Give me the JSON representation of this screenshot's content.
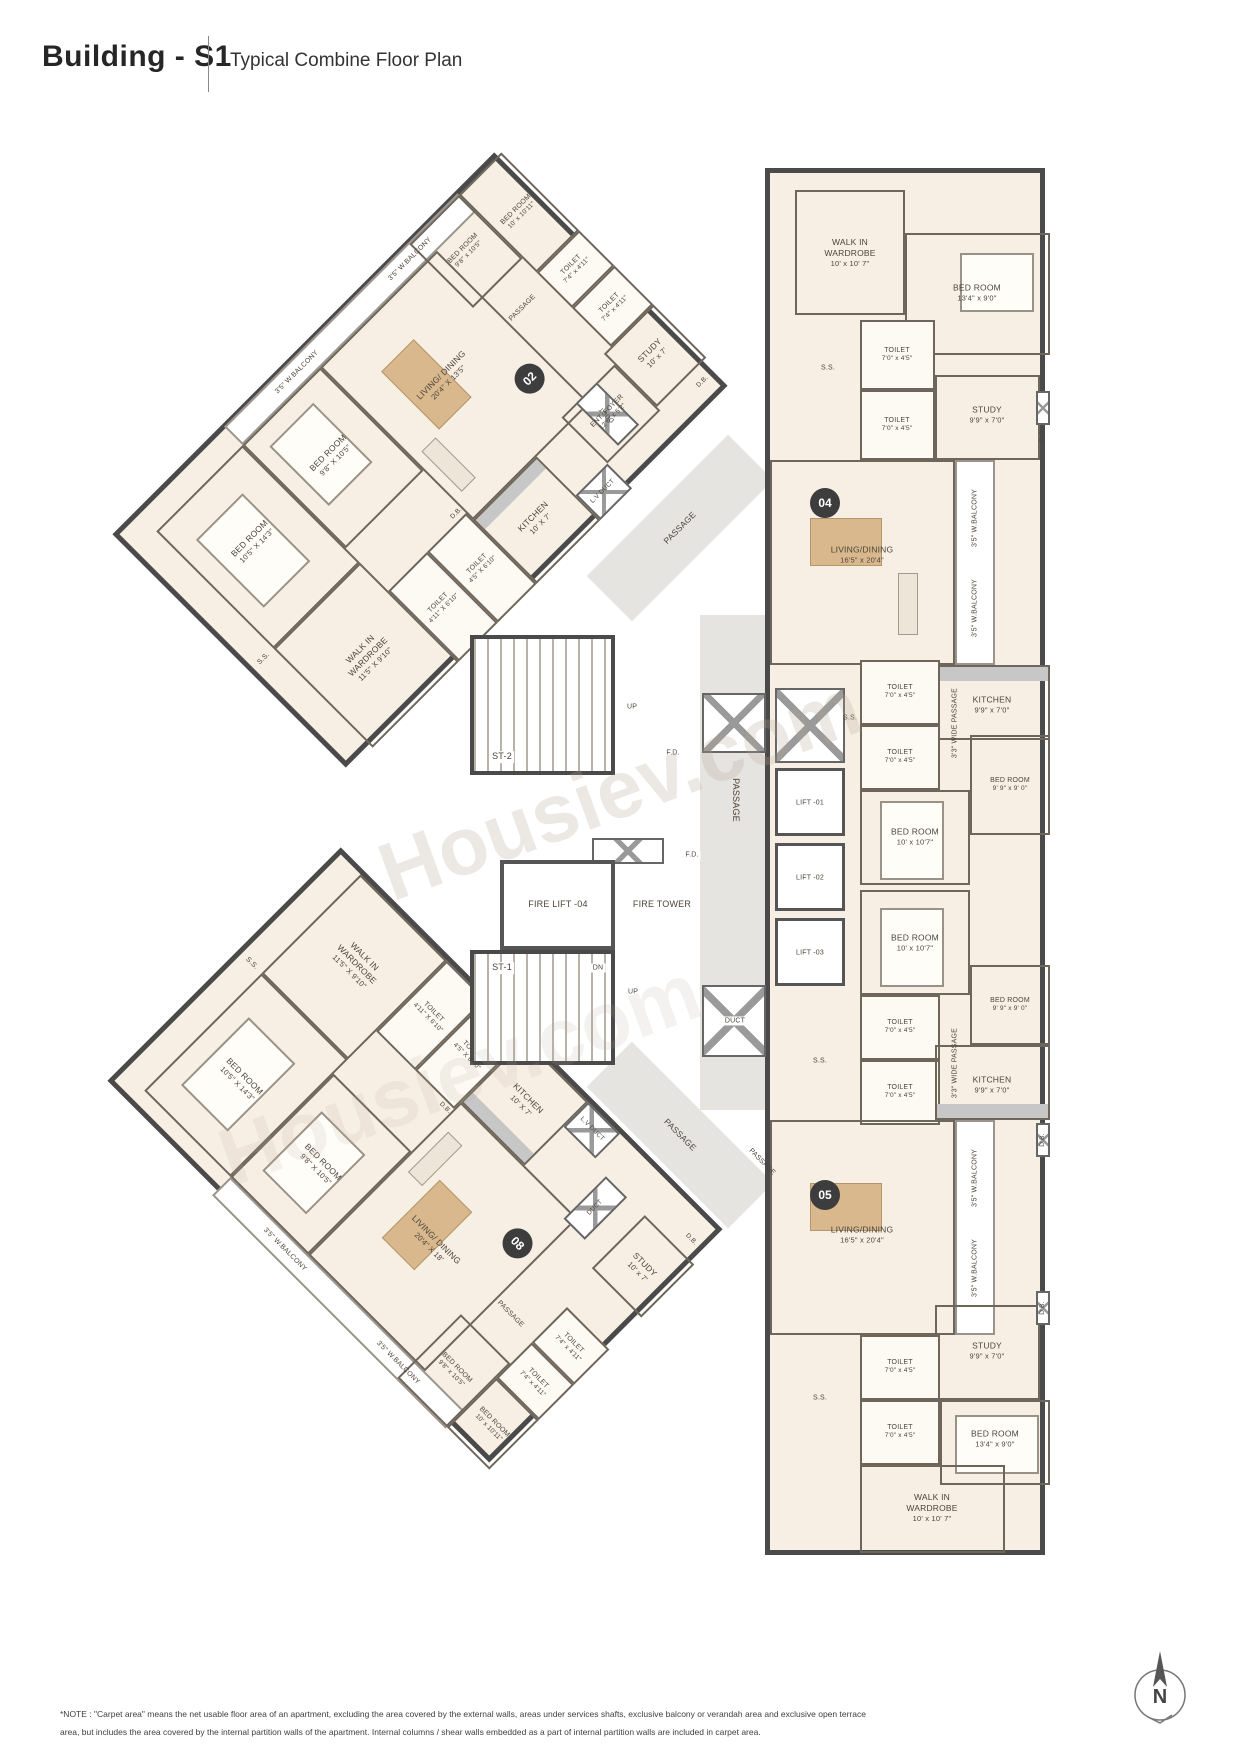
{
  "header": {
    "building": "Building - S1",
    "subtitle": "Typical Combine Floor Plan"
  },
  "watermark": "Housiev.com",
  "compass": {
    "label": "N"
  },
  "colors": {
    "wall": "#4a4a4a",
    "room_fill": "#f8efe4",
    "furniture_tan": "#d8b88c",
    "passage_gray": "#e6e4e1",
    "badge_bg": "#3d3d3d"
  },
  "core": {
    "st1": "ST-1",
    "st2": "ST-2",
    "up": "UP",
    "dn": "DN",
    "fd": "F.D.",
    "duct": "DUCT",
    "passage": "PASSAGE",
    "lift1": "LIFT -01",
    "lift2": "LIFT -02",
    "lift3": "LIFT -03",
    "fire_lift": "FIRE LIFT -04",
    "fire_tower": "FIRE TOWER"
  },
  "units": {
    "u02": {
      "badge": "02",
      "rooms": {
        "living": {
          "n": "LIVING/ DINING",
          "s": "20'4\" X 13'5\""
        },
        "ent_foyer": {
          "n": "ENT. FOYER",
          "s": "12'6\" x 5'2\""
        },
        "study": {
          "n": "STUDY",
          "s": "10' x 7'"
        },
        "kitchen": {
          "n": "KITCHEN",
          "s": "10' X 7'"
        },
        "bed_a": {
          "n": "BED ROOM",
          "s": "9'8\" x 10'5\""
        },
        "bed_b": {
          "n": "BED ROOM",
          "s": "10' x 10'11\""
        },
        "bed_c": {
          "n": "BED ROOM",
          "s": "9'8\" X 10'5\""
        },
        "bed_d": {
          "n": "BED ROOM",
          "s": "10'5\" X 14'3\""
        },
        "toilet_a": {
          "n": "TOILET",
          "s": "7'4\" x 4'11\""
        },
        "toilet_b": {
          "n": "TOILET",
          "s": "7'4\" x 4'11\""
        },
        "toilet_c": {
          "n": "TOILET",
          "s": "4'11\" X 6'10\""
        },
        "toilet_d": {
          "n": "TOILET",
          "s": "4'5\" X 6'10\""
        },
        "wiw": {
          "n": "WALK IN WARDROBE",
          "s": "11'5\" X 9'10\""
        },
        "passage": "PASSAGE",
        "balcony": "3'5\" W.BALCONY",
        "ss": "S.S.",
        "db": "D.B.",
        "duct": "DUCT",
        "lv_duct": "L.V DUCT"
      }
    },
    "u08": {
      "badge": "08",
      "rooms": {
        "living": {
          "n": "LIVING/ DINING",
          "s": "20'4\" X 18'"
        },
        "study": {
          "n": "STUDY",
          "s": "10' x 7'"
        },
        "kitchen": {
          "n": "KITCHEN",
          "s": "10' X 7'"
        },
        "bed_a": {
          "n": "BED ROOM",
          "s": "9'8\" x 10'5\""
        },
        "bed_b": {
          "n": "BED ROOM",
          "s": "10' x 10'11\""
        },
        "bed_c": {
          "n": "BED ROOM",
          "s": "9'8\" X 10'5\""
        },
        "bed_d": {
          "n": "BED ROOM",
          "s": "10'5\" X 14'3\""
        },
        "toilet_a": {
          "n": "TOILET",
          "s": "7'4\" x 4'11\""
        },
        "toilet_b": {
          "n": "TOILET",
          "s": "7'4\" x 4'11\""
        },
        "toilet_c": {
          "n": "TOILET",
          "s": "4'11\" X 6'10\""
        },
        "toilet_d": {
          "n": "TOILET",
          "s": "4'5\" X 6'10\""
        },
        "wiw": {
          "n": "WALK IN WARDROBE",
          "s": "11'5\" X 9'10\""
        },
        "passage": "PASSAGE",
        "balcony": "3'5\" W.BALCONY",
        "ss": "S.S.",
        "db": "D.B.",
        "duct": "DUCT",
        "lv_duct": "L.V DUCT"
      }
    },
    "u04": {
      "badge": "04",
      "rooms": {
        "living": {
          "n": "LIVING/DINING",
          "s": "16'5\" x 20'4\""
        },
        "study": {
          "n": "STUDY",
          "s": "9'9\" x 7'0\""
        },
        "kitchen": {
          "n": "KITCHEN",
          "s": "9'9\" x 7'0\""
        },
        "bed_a": {
          "n": "BED ROOM",
          "s": "13'4\" x 9'0\""
        },
        "bed_b": {
          "n": "BED ROOM",
          "s": "9' 9\" x 9' 0\""
        },
        "bed_c": {
          "n": "BED ROOM",
          "s": "10' x 10'7\""
        },
        "toilet": {
          "n": "TOILET",
          "s": "7'0\" x 4'5\""
        },
        "wiw": {
          "n": "WALK IN WARDROBE",
          "s": "10' x 10' 7\""
        },
        "wide_passage": "3'3\" WIDE PASSAGE",
        "balcony": "3'5\" W.BALCONY",
        "ss": "S.S.",
        "db": "D.B."
      }
    },
    "u05": {
      "badge": "05",
      "rooms": {
        "living": {
          "n": "LIVING/DINING",
          "s": "16'5\" x 20'4\""
        },
        "study": {
          "n": "STUDY",
          "s": "9'9\" x 7'0\""
        },
        "kitchen": {
          "n": "KITCHEN",
          "s": "9'9\" x 7'0\""
        },
        "bed_a": {
          "n": "BED ROOM",
          "s": "13'4\" x 9'0\""
        },
        "bed_b": {
          "n": "BED ROOM",
          "s": "9' 9\" x 9' 0\""
        },
        "bed_c": {
          "n": "BED ROOM",
          "s": "10' x 10'7\""
        },
        "toilet": {
          "n": "TOILET",
          "s": "7'0\" x 4'5\""
        },
        "wiw": {
          "n": "WALK IN WARDROBE",
          "s": "10' x 10' 7\""
        },
        "wide_passage": "3'3\" WIDE PASSAGE",
        "balcony": "3'5\" W.BALCONY",
        "ss": "S.S.",
        "db": "D.B."
      }
    }
  },
  "note": {
    "line1": "*NOTE : \"Carpet area\" means the net usable floor area of an apartment, excluding the area covered by the external walls, areas under services shafts, exclusive balcony or verandah area and exclusive open terrace",
    "line2": "area, but includes the area covered by the internal partition walls of the apartment. Internal columns / shear walls embedded as a part of internal partition walls are included in carpet area."
  }
}
